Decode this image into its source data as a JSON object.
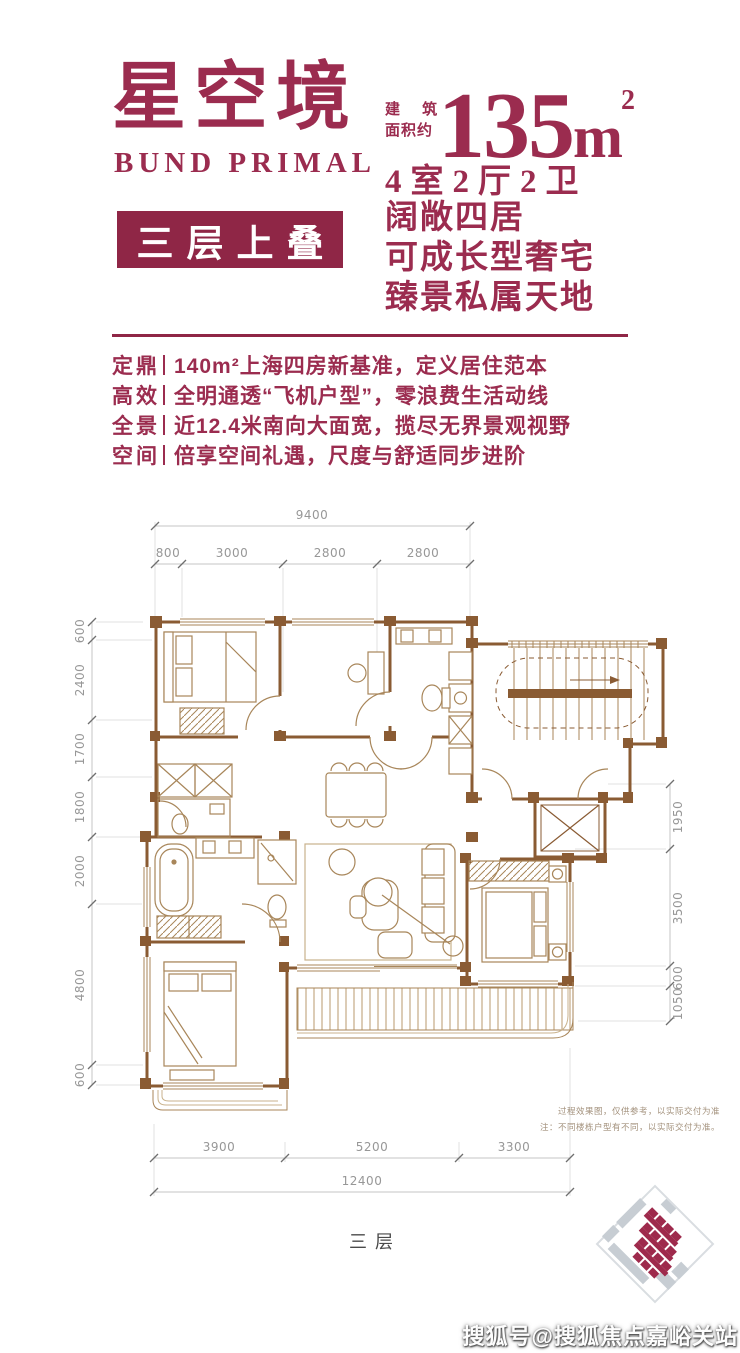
{
  "colors": {
    "accent": "#9b2c4f",
    "badge": "#8f2646",
    "plan_wall": "#8a5b33",
    "plan_line": "#a8865a"
  },
  "header": {
    "title_cn": "星空境",
    "title_en": "BUND PRIMAL",
    "badge": "三层上叠",
    "area_label_line1": "建 筑",
    "area_label_line2": "面积约",
    "area_value": "135",
    "area_unit_base": "m",
    "area_unit_sup": "2",
    "rooms": "4室2厅2卫",
    "slogan_lines": [
      "阔敞四居",
      "可成长型奢宅",
      "臻景私属天地"
    ]
  },
  "features": [
    {
      "label": "定鼎",
      "text": "140m²上海四房新基准，定义居住范本"
    },
    {
      "label": "高效",
      "text": "全明通透“飞机户型”，零浪费生活动线"
    },
    {
      "label": "全景",
      "text": "近12.4米南向大面宽，揽尽无界景观视野"
    },
    {
      "label": "空间",
      "text": "倍享空间礼遇，尺度与舒适同步进阶"
    }
  ],
  "floorplan": {
    "dims_top_total": "9400",
    "dims_top": [
      "800",
      "3000",
      "2800",
      "2800"
    ],
    "dims_left": [
      "600",
      "2400",
      "1700",
      "1800",
      "2000",
      "4800",
      "600"
    ],
    "dims_right": [
      "1950",
      "3500",
      "600",
      "1050"
    ],
    "dims_bottom": [
      "3900",
      "5200",
      "3300"
    ],
    "dims_bottom_total": "12400",
    "floor_label": "三层",
    "disclaimer_line1": "过程效果图，仅供参考，以实际交付为准",
    "disclaimer_line2": "注：不同楼栋户型有不同，以实际交付为准。"
  },
  "watermark": "搜狐号@搜狐焦点嘉峪关站"
}
